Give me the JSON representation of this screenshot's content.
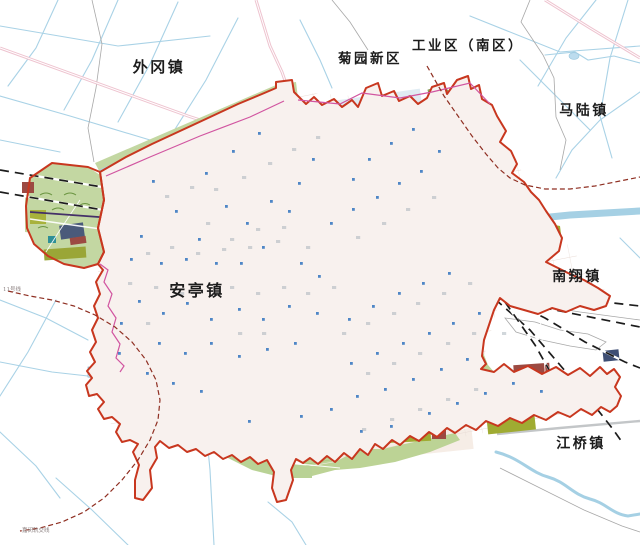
{
  "map": {
    "labels": [
      {
        "name": "waigang-town",
        "text": "外冈镇"
      },
      {
        "name": "juyuan-new-district",
        "text": "菊园新区"
      },
      {
        "name": "industrial-zone-south",
        "text": "工业区（南区）"
      },
      {
        "name": "malu-town",
        "text": "马陆镇"
      },
      {
        "name": "nanxiang-town",
        "text": "南翔镇"
      },
      {
        "name": "anting-town",
        "text": "安亭镇"
      },
      {
        "name": "jiangqiao-town",
        "text": "江桥镇"
      }
    ],
    "tiny_labels": [
      {
        "name": "line-label-west",
        "text": "11号线"
      },
      {
        "name": "line-label-south",
        "text": "嘉闵轨交线"
      }
    ],
    "colors": {
      "boundary": "#c8371f",
      "magenta": "#d155a0",
      "dashedline": "#8f2f22",
      "railway": "#1c1c1c",
      "transit": "#443068",
      "canal": "#a9d2e6",
      "hatchblue": "#8fc0da",
      "fabric": "#f8f1ee",
      "green": "#c3d7a2",
      "greendark": "#86ad58",
      "olive": "#9fab32",
      "maroon": "#9c4a42",
      "slate": "#4a5a7a",
      "teal": "#2e8f96",
      "lake": "#2f86b6",
      "dot": "#4f86c6",
      "pinkroad": "#eec3cf"
    },
    "blue_dots": [
      [
        152,
        180
      ],
      [
        175,
        210
      ],
      [
        140,
        235
      ],
      [
        205,
        172
      ],
      [
        232,
        150
      ],
      [
        258,
        132
      ],
      [
        225,
        205
      ],
      [
        198,
        238
      ],
      [
        246,
        222
      ],
      [
        270,
        200
      ],
      [
        298,
        182
      ],
      [
        312,
        158
      ],
      [
        288,
        210
      ],
      [
        262,
        246
      ],
      [
        240,
        262
      ],
      [
        215,
        262
      ],
      [
        185,
        258
      ],
      [
        160,
        262
      ],
      [
        130,
        258
      ],
      [
        330,
        222
      ],
      [
        352,
        208
      ],
      [
        376,
        196
      ],
      [
        398,
        182
      ],
      [
        420,
        170
      ],
      [
        352,
        178
      ],
      [
        368,
        158
      ],
      [
        390,
        142
      ],
      [
        412,
        128
      ],
      [
        438,
        150
      ],
      [
        300,
        262
      ],
      [
        318,
        275
      ],
      [
        138,
        300
      ],
      [
        162,
        312
      ],
      [
        186,
        302
      ],
      [
        210,
        318
      ],
      [
        238,
        308
      ],
      [
        262,
        318
      ],
      [
        288,
        305
      ],
      [
        316,
        312
      ],
      [
        158,
        342
      ],
      [
        184,
        352
      ],
      [
        210,
        342
      ],
      [
        238,
        355
      ],
      [
        266,
        348
      ],
      [
        294,
        342
      ],
      [
        348,
        318
      ],
      [
        372,
        305
      ],
      [
        398,
        292
      ],
      [
        422,
        282
      ],
      [
        448,
        272
      ],
      [
        350,
        362
      ],
      [
        376,
        352
      ],
      [
        402,
        342
      ],
      [
        428,
        332
      ],
      [
        452,
        322
      ],
      [
        478,
        312
      ],
      [
        356,
        395
      ],
      [
        384,
        388
      ],
      [
        412,
        378
      ],
      [
        440,
        368
      ],
      [
        466,
        358
      ],
      [
        300,
        415
      ],
      [
        330,
        408
      ],
      [
        428,
        412
      ],
      [
        456,
        402
      ],
      [
        484,
        392
      ],
      [
        512,
        382
      ],
      [
        200,
        390
      ],
      [
        172,
        382
      ],
      [
        146,
        372
      ],
      [
        120,
        322
      ],
      [
        118,
        352
      ],
      [
        360,
        430
      ],
      [
        390,
        425
      ],
      [
        248,
        420
      ],
      [
        540,
        390
      ]
    ],
    "speckles": [
      [
        165,
        195
      ],
      [
        190,
        186
      ],
      [
        214,
        188
      ],
      [
        242,
        176
      ],
      [
        268,
        162
      ],
      [
        292,
        148
      ],
      [
        316,
        136
      ],
      [
        206,
        222
      ],
      [
        230,
        238
      ],
      [
        256,
        228
      ],
      [
        282,
        226
      ],
      [
        306,
        246
      ],
      [
        146,
        252
      ],
      [
        170,
        246
      ],
      [
        196,
        252
      ],
      [
        222,
        248
      ],
      [
        248,
        246
      ],
      [
        276,
        240
      ],
      [
        128,
        282
      ],
      [
        154,
        286
      ],
      [
        180,
        292
      ],
      [
        230,
        286
      ],
      [
        256,
        292
      ],
      [
        282,
        286
      ],
      [
        306,
        292
      ],
      [
        332,
        286
      ],
      [
        356,
        236
      ],
      [
        382,
        222
      ],
      [
        406,
        208
      ],
      [
        432,
        196
      ],
      [
        146,
        322
      ],
      [
        238,
        332
      ],
      [
        262,
        332
      ],
      [
        342,
        332
      ],
      [
        366,
        322
      ],
      [
        392,
        312
      ],
      [
        416,
        302
      ],
      [
        442,
        292
      ],
      [
        468,
        282
      ],
      [
        366,
        372
      ],
      [
        392,
        362
      ],
      [
        418,
        352
      ],
      [
        446,
        342
      ],
      [
        472,
        332
      ],
      [
        362,
        428
      ],
      [
        390,
        418
      ],
      [
        418,
        408
      ],
      [
        446,
        398
      ],
      [
        474,
        388
      ],
      [
        502,
        332
      ]
    ]
  }
}
